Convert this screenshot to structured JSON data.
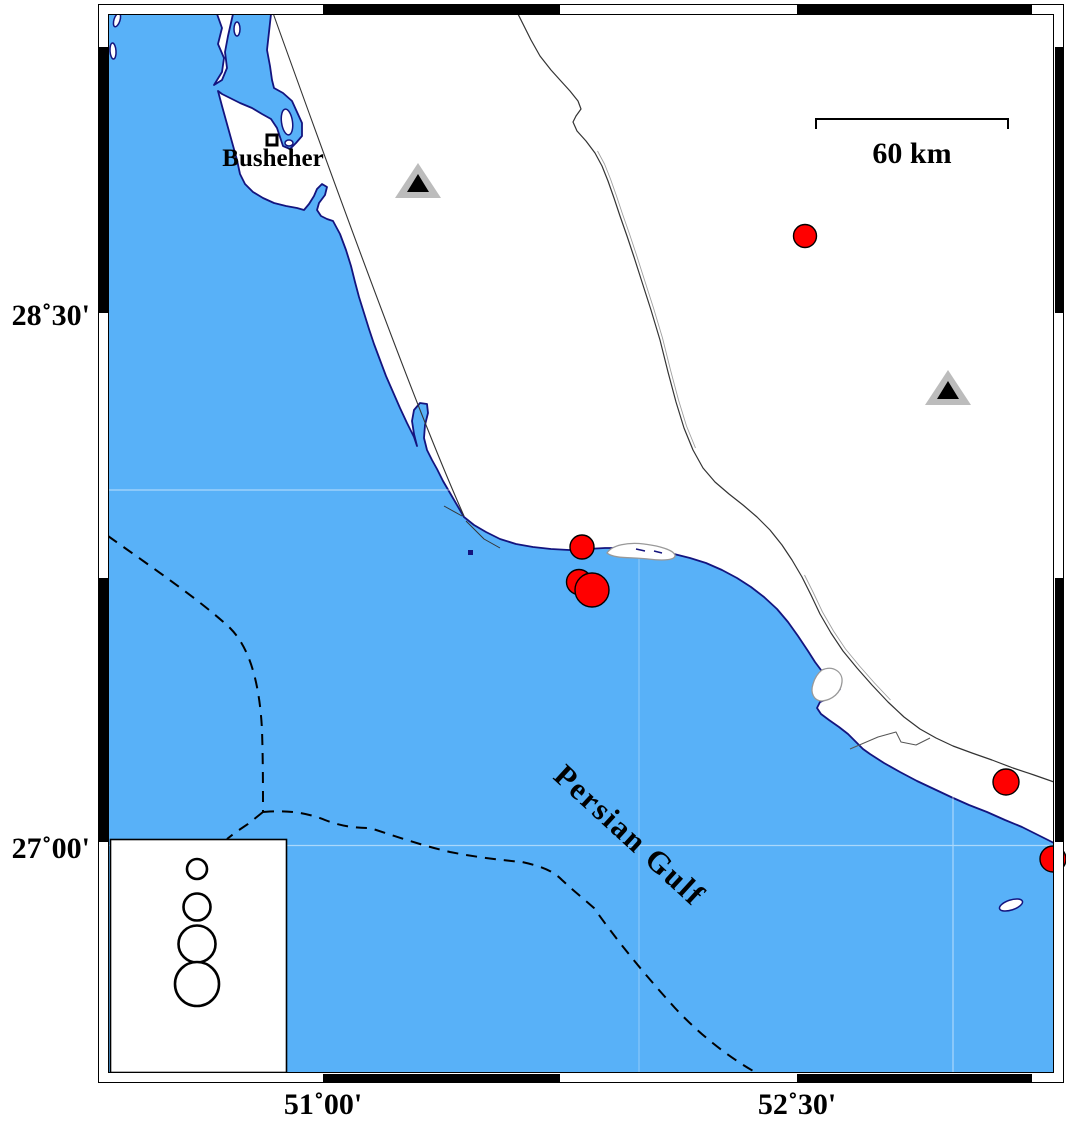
{
  "labels": {
    "city": "Busheher",
    "sea": "Persian Gulf",
    "scale_bar": "60 km"
  },
  "frame": {
    "axis_left": [
      {
        "label": "28˚30'",
        "y": 313
      },
      {
        "label": "27˚00'",
        "y": 846
      }
    ],
    "axis_bottom": [
      {
        "label": "51˚00'",
        "x": 323
      },
      {
        "label": "52˚30'",
        "x": 797
      }
    ]
  },
  "markers": {
    "earthquakes": [
      {
        "x": 805,
        "y": 236,
        "r": 11.5
      },
      {
        "x": 582,
        "y": 547,
        "r": 12
      },
      {
        "x": 579,
        "y": 582,
        "r": 12.5
      },
      {
        "x": 592,
        "y": 590,
        "r": 17
      },
      {
        "x": 1006,
        "y": 782,
        "r": 13
      },
      {
        "x": 1053,
        "y": 859,
        "r": 13
      }
    ],
    "stations": [
      {
        "x": 418,
        "y": 181
      },
      {
        "x": 948,
        "y": 388
      }
    ]
  },
  "legend": {
    "circles": [
      {
        "cy": 869,
        "r": 10
      },
      {
        "cy": 907,
        "r": 13.5
      },
      {
        "cy": 944,
        "r": 18.5
      },
      {
        "cy": 984,
        "r": 22
      }
    ]
  },
  "colors": {
    "sea": "#58B1F8",
    "coast": "#14147E",
    "earthquake": "#FF0000",
    "station_outer": "#BCBCBC",
    "station_inner": "#000000"
  }
}
